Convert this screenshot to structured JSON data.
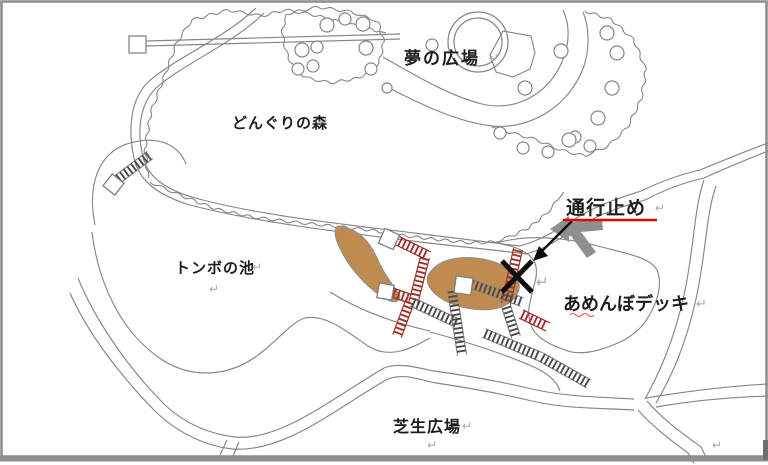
{
  "map": {
    "labels": {
      "dream_plaza": "夢の広場",
      "acorn_forest": "どんぐりの森",
      "dragonfly_pond": "トンボの池",
      "road_closed": "通行止め",
      "amenbo_deck": "あめんぼデッキ",
      "lawn_plaza": "芝生広場"
    },
    "paragraph_mark": "↵",
    "colors": {
      "map_line": "#868686",
      "pond_fill": "#c08b50",
      "pond_edge": "#8d8d8d",
      "deck_red": "#9e332c",
      "deck_gray_rail": "#8a8a8a",
      "deck_gray_rung": "#4a4a4a",
      "closure_underline": "#e90000",
      "spellcheck_squiggle": "#ff6666",
      "annotation_black": "#0d0d0d",
      "gray_arrow": "#8f8f8f",
      "border": "#8a8a8a"
    }
  }
}
